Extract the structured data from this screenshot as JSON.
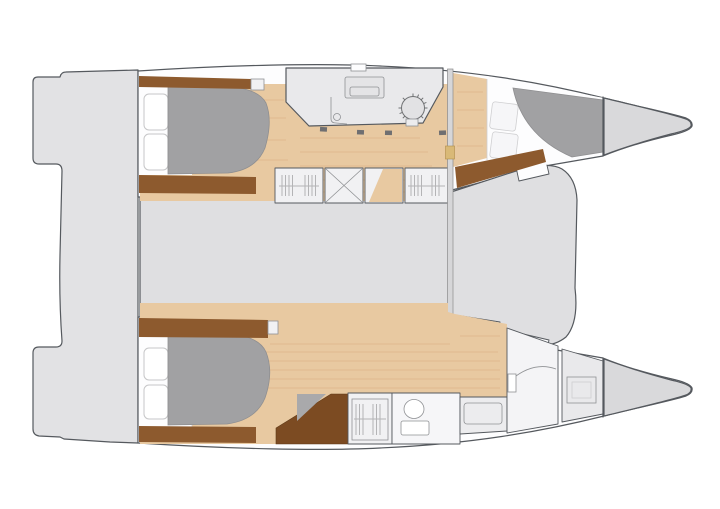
{
  "diagram": {
    "type": "floor-plan",
    "subject": "catamaran-yacht-cabin-layout-top-view",
    "orientation": {
      "bow": "right",
      "stern": "left"
    },
    "regions": [
      {
        "name": "stern-swim-platforms",
        "count": 2
      },
      {
        "name": "aft-deck"
      },
      {
        "name": "port-hull-aft-cabin",
        "features": [
          "double-berth",
          "hull-windows",
          "wardrobe-trim"
        ]
      },
      {
        "name": "helm-station",
        "features": [
          "instrument-console",
          "steering-wheel",
          "seat",
          "deck-hatch"
        ]
      },
      {
        "name": "port-hull-forward-cabin",
        "features": [
          "double-berth",
          "deck-hatches"
        ]
      },
      {
        "name": "port-bow-locker"
      },
      {
        "name": "saloon-bridgedeck"
      },
      {
        "name": "mast-beam-bulkhead"
      },
      {
        "name": "storage-lockers-top-row",
        "count": 4,
        "features": [
          "slatted-doors",
          "cross-braced-door"
        ]
      },
      {
        "name": "storage-lockers-bottom-row",
        "count": 4,
        "features": [
          "slatted-doors"
        ]
      },
      {
        "name": "starboard-hull-aft-cabin",
        "features": [
          "double-berth",
          "hull-windows"
        ]
      },
      {
        "name": "companionway-stairs"
      },
      {
        "name": "wardrobe-cabinet"
      },
      {
        "name": "bathroom",
        "features": [
          "toilet"
        ]
      },
      {
        "name": "bench-seat"
      },
      {
        "name": "forward-bathroom",
        "features": [
          "vanity"
        ]
      },
      {
        "name": "shower-room",
        "features": [
          "shower-tray"
        ]
      },
      {
        "name": "starboard-bow-locker"
      }
    ]
  },
  "colors": {
    "background": "#ffffff",
    "deck": "#e2e2e4",
    "saloon": "#dfdfe1",
    "room": "#e9e9eb",
    "bow": "#d9d9db",
    "bed": "#a1a1a3",
    "wood": "#e8c9a1",
    "woodgrain": "#cf9f6f",
    "trim": "#8d5a2e",
    "stairs": "#7c4b22",
    "cap": "#d9b977",
    "outline": "#55595e",
    "boxfill": "#f1f1f3",
    "boxline": "#8f9194",
    "hatch": "#b4b4b6",
    "windowline": "#c6c6c8",
    "faint": "#cfcfd1"
  }
}
